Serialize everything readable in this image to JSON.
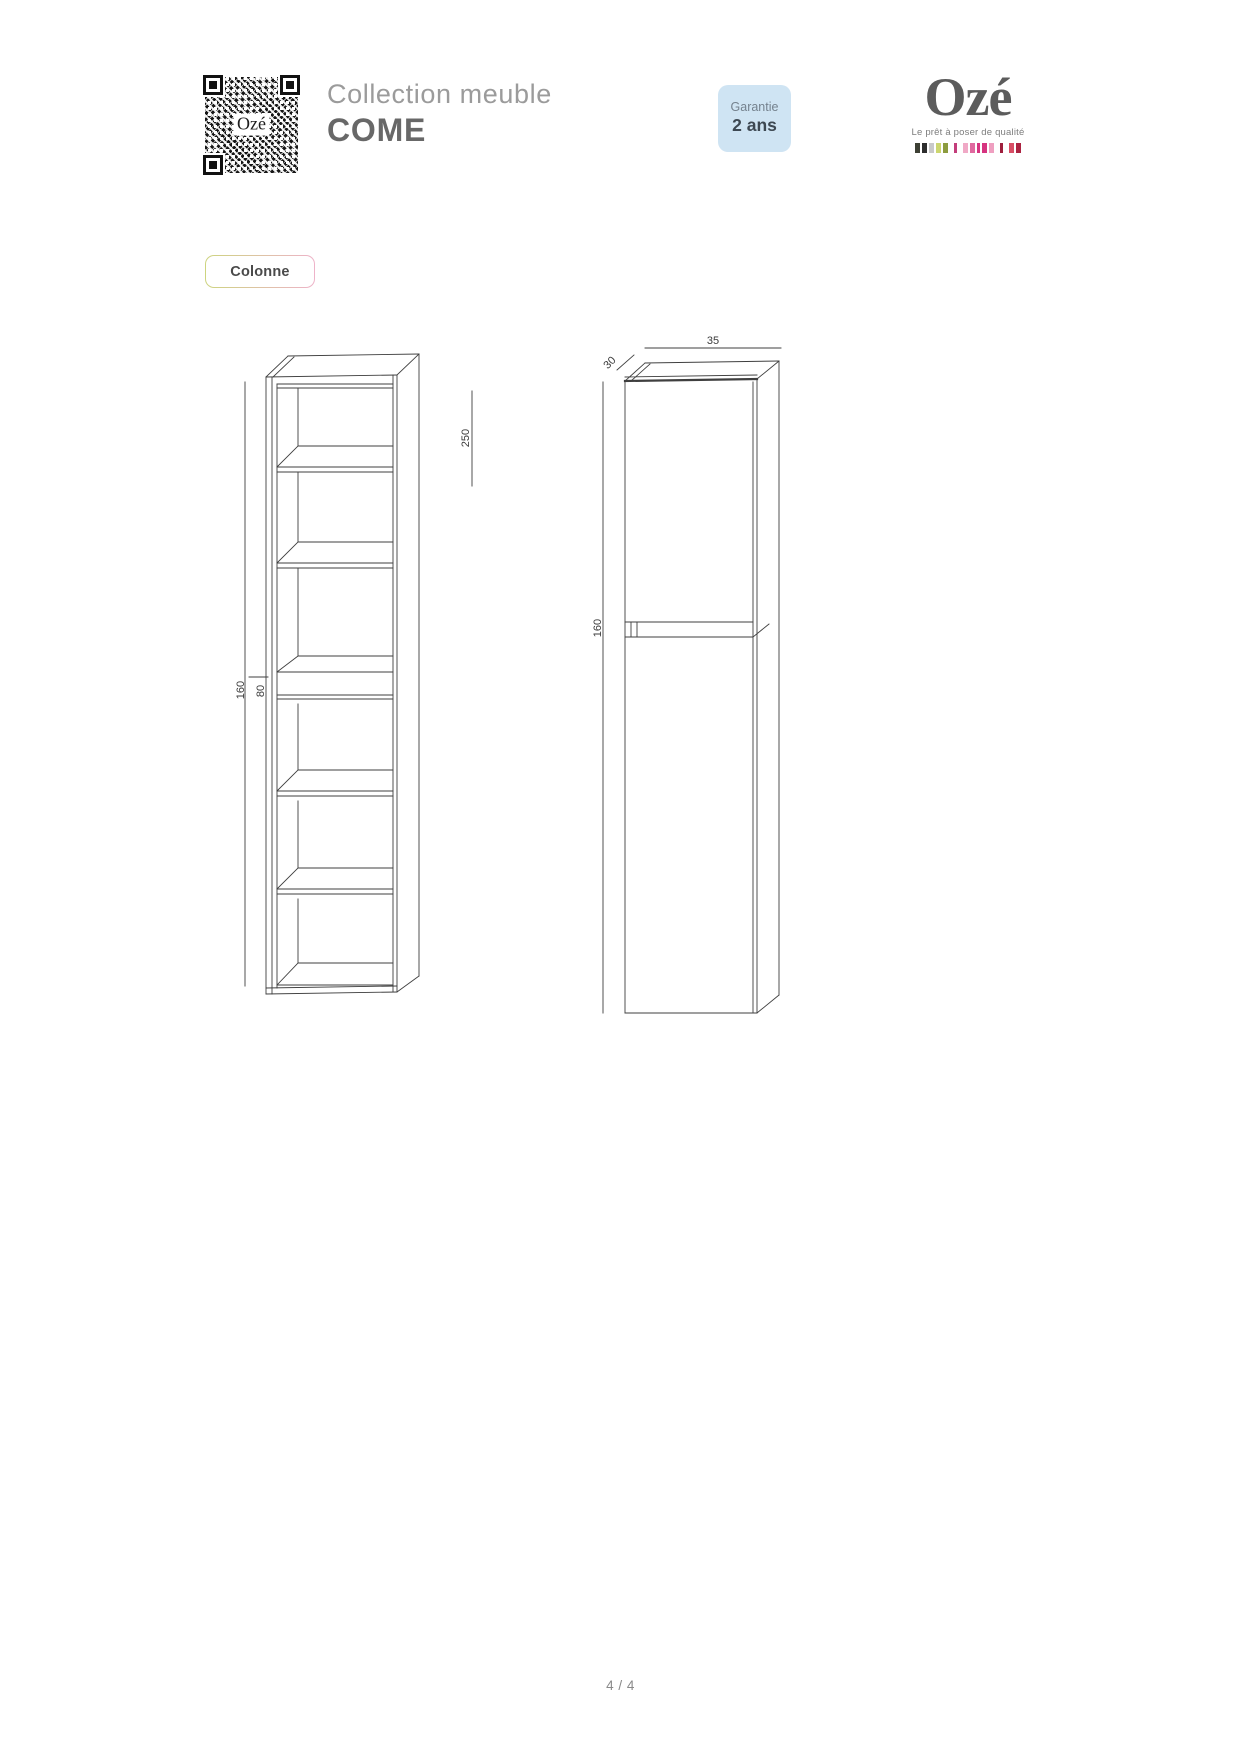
{
  "header": {
    "collection_label": "Collection meuble",
    "collection_name": "COME",
    "qr_center_label": "Ozé",
    "warranty": {
      "title": "Garantie",
      "duration": "2 ans"
    },
    "logo": {
      "brand": "Ozé",
      "tagline": "Le prêt à poser de qualité",
      "palette": [
        {
          "color": "#3d4034",
          "w": 5,
          "gap": 0
        },
        {
          "color": "#2e2e2e",
          "w": 5,
          "gap": 2
        },
        {
          "color": "#c9c9c9",
          "w": 5,
          "gap": 2
        },
        {
          "color": "#ccd66f",
          "w": 5,
          "gap": 2
        },
        {
          "color": "#8d9c3f",
          "w": 5,
          "gap": 2
        },
        {
          "color": "#c33d7b",
          "w": 3,
          "gap": 6
        },
        {
          "color": "#f0a9c6",
          "w": 5,
          "gap": 6
        },
        {
          "color": "#e0699f",
          "w": 5,
          "gap": 2
        },
        {
          "color": "#d63480",
          "w": 3,
          "gap": 2
        },
        {
          "color": "#d63480",
          "w": 5,
          "gap": 2
        },
        {
          "color": "#ef9fc0",
          "w": 5,
          "gap": 2
        },
        {
          "color": "#9e1f3d",
          "w": 3,
          "gap": 6
        },
        {
          "color": "#d84e65",
          "w": 5,
          "gap": 6
        },
        {
          "color": "#ac2341",
          "w": 5,
          "gap": 2
        }
      ]
    }
  },
  "section_label": "Colonne",
  "drawings": {
    "front_view": {
      "description": "open column with six shelf compartments, front perspective",
      "dims": {
        "total_height": "160",
        "mid_height": "80",
        "clearance": "250"
      }
    },
    "perspective_view": {
      "description": "column with two doors, perspective view",
      "dims": {
        "total_height": "160",
        "width": "35",
        "depth": "30"
      }
    }
  },
  "footer": {
    "page_indicator": "4 / 4"
  },
  "colors": {
    "warranty_bg": "#cfe4f3",
    "section_border_left": "#cdd47f",
    "section_border_right": "#eeb3c9",
    "drawing_line": "#3f3f3f"
  }
}
